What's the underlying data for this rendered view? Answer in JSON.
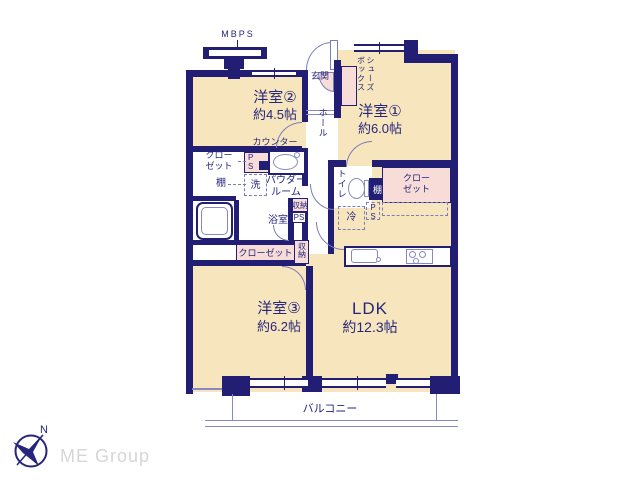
{
  "colors": {
    "wall": "#211e73",
    "room_fill": "#f7e5bd",
    "closet_fill": "#f8dcd8",
    "line": "#8789c0",
    "arc": "#7a7db8",
    "text": "#26267c",
    "logo_text": "#d6d6d6"
  },
  "plan": {
    "mbps": "MBPS",
    "entrance": "玄関",
    "shoe_box": "シューズ\nボックス",
    "room2_name": "洋室②",
    "room2_size": "約4.5帖",
    "room1_name": "洋室①",
    "room1_size": "約6.0帖",
    "room3_name": "洋室③",
    "room3_size": "約6.2帖",
    "ldk_name": "LDK",
    "ldk_size": "約12.3帖",
    "hall": "ホール",
    "counter": "カウンター",
    "closet": "クロー\nゼット",
    "closet_single": "クローゼット",
    "shelf": "棚",
    "washer": "洗",
    "powder_room": "パウダー\nルーム",
    "ps_stacked": "P\nS",
    "ps": "PS",
    "toilet": "トイレ",
    "fridge": "冷",
    "storage": "収納",
    "bath": "浴室",
    "balcony": "バルコニー"
  },
  "logo": {
    "compass_n": "N",
    "brand": "ME Group"
  }
}
